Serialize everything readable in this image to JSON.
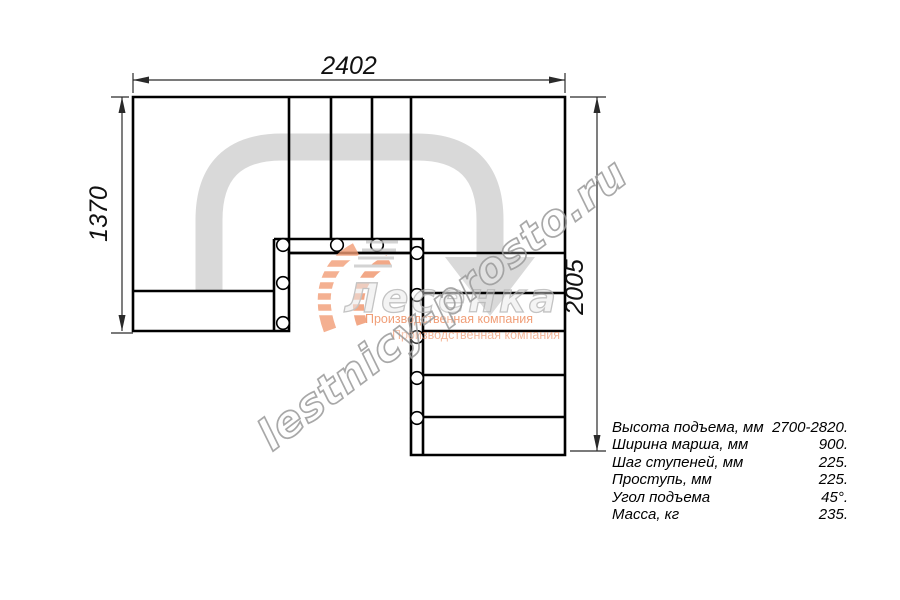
{
  "dimensions": {
    "top_width_mm": "2402",
    "left_height_mm": "1370",
    "right_height_mm": "2005"
  },
  "watermark": {
    "site": "lestnicy-prosto.ru",
    "logo_name": "Лесенка",
    "company": "Производственная компания"
  },
  "specs": {
    "rows": [
      {
        "label": "Высота подъема, мм",
        "value": "2700-2820."
      },
      {
        "label": "Ширина марша, мм",
        "value": "900."
      },
      {
        "label": "Шаг ступеней, мм",
        "value": "225."
      },
      {
        "label": "Проступь, мм",
        "value": "225."
      },
      {
        "label": "Угол подъема",
        "value": "45°."
      },
      {
        "label": "Масса, кг",
        "value": "235."
      }
    ]
  },
  "colors": {
    "outline": "#000000",
    "dimension_lines": "#2a2a2a",
    "walk_line": "#d9d9d9",
    "watermark_outline": "#999999",
    "logo_orange": "#f29d76",
    "slogan_orange": "#ed8757"
  }
}
